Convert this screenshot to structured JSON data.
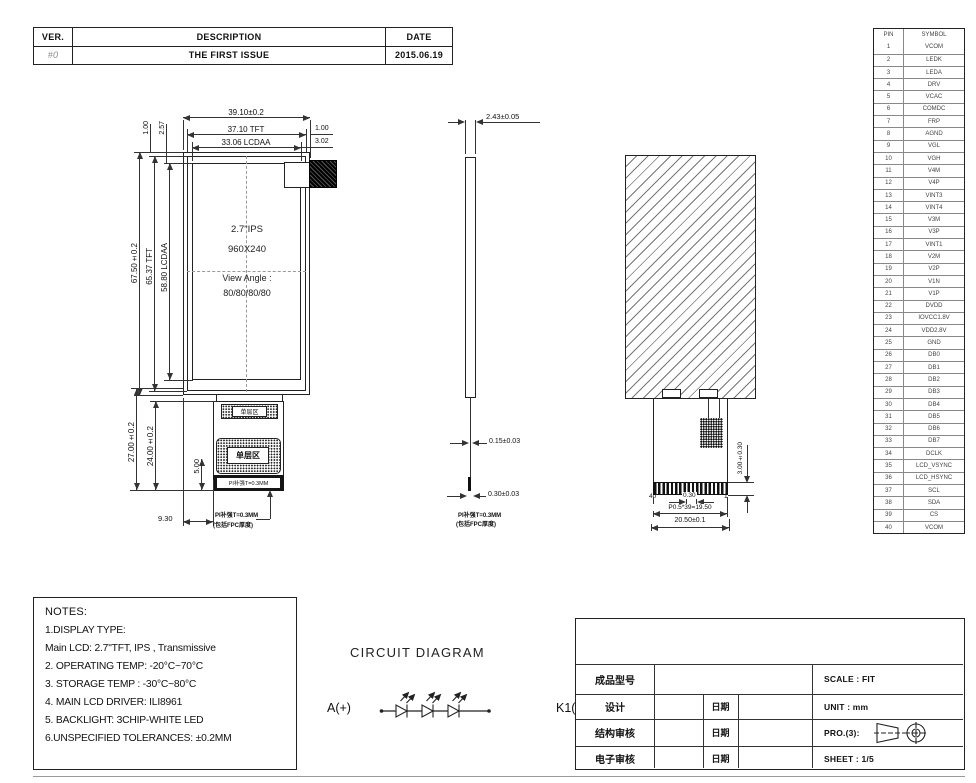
{
  "revision_table": {
    "headers": {
      "ver": "VER.",
      "description": "DESCRIPTION",
      "date": "DATE"
    },
    "rows": [
      {
        "ver": "#0",
        "description": "THE FIRST ISSUE",
        "date": "2015.06.19"
      }
    ]
  },
  "pin_table": {
    "col_pin": "PIN",
    "col_symbol": "SYMBOL",
    "pins": [
      {
        "pin": "1",
        "symbol": "VCOM"
      },
      {
        "pin": "2",
        "symbol": "LEDK"
      },
      {
        "pin": "3",
        "symbol": "LEDA"
      },
      {
        "pin": "4",
        "symbol": "DRV"
      },
      {
        "pin": "5",
        "symbol": "VCAC"
      },
      {
        "pin": "6",
        "symbol": "COMDC"
      },
      {
        "pin": "7",
        "symbol": "FRP"
      },
      {
        "pin": "8",
        "symbol": "AGND"
      },
      {
        "pin": "9",
        "symbol": "VGL"
      },
      {
        "pin": "10",
        "symbol": "VGH"
      },
      {
        "pin": "11",
        "symbol": "V4M"
      },
      {
        "pin": "12",
        "symbol": "V4P"
      },
      {
        "pin": "13",
        "symbol": "VINT3"
      },
      {
        "pin": "14",
        "symbol": "VINT4"
      },
      {
        "pin": "15",
        "symbol": "V3M"
      },
      {
        "pin": "16",
        "symbol": "V3P"
      },
      {
        "pin": "17",
        "symbol": "VINT1"
      },
      {
        "pin": "18",
        "symbol": "V2M"
      },
      {
        "pin": "19",
        "symbol": "V2P"
      },
      {
        "pin": "20",
        "symbol": "V1N"
      },
      {
        "pin": "21",
        "symbol": "V1P"
      },
      {
        "pin": "22",
        "symbol": "DVDD"
      },
      {
        "pin": "23",
        "symbol": "IOVCC1.8V"
      },
      {
        "pin": "24",
        "symbol": "VDD2.8V"
      },
      {
        "pin": "25",
        "symbol": "GND"
      },
      {
        "pin": "26",
        "symbol": "DB0"
      },
      {
        "pin": "27",
        "symbol": "DB1"
      },
      {
        "pin": "28",
        "symbol": "DB2"
      },
      {
        "pin": "29",
        "symbol": "DB3"
      },
      {
        "pin": "30",
        "symbol": "DB4"
      },
      {
        "pin": "31",
        "symbol": "DB5"
      },
      {
        "pin": "32",
        "symbol": "DB6"
      },
      {
        "pin": "33",
        "symbol": "DB7"
      },
      {
        "pin": "34",
        "symbol": "DCLK"
      },
      {
        "pin": "35",
        "symbol": "LCD_VSYNC"
      },
      {
        "pin": "36",
        "symbol": "LCD_HSYNC"
      },
      {
        "pin": "37",
        "symbol": "SCL"
      },
      {
        "pin": "38",
        "symbol": "SDA"
      },
      {
        "pin": "39",
        "symbol": "CS"
      },
      {
        "pin": "40",
        "symbol": "VCOM"
      }
    ]
  },
  "front_view": {
    "display_text": {
      "line1": "2.7\"IPS",
      "line2": "960X240",
      "line3": "View Angle :",
      "line4": "80/80/80/80"
    },
    "dims": {
      "width_overall": "39.10±0.2",
      "width_tft": "37.10 TFT",
      "width_aa": "33.06 LCDAA",
      "margin_right_tft": "1.00",
      "margin_right_aa": "3.02",
      "margin_top_tft": "1.00",
      "margin_top_aa": "2.57",
      "height_overall": "67.50±0.2",
      "height_tft": "65.37 TFT",
      "height_aa": "58.80 LCDAA",
      "fpc_height_overall": "27.00±0.2",
      "fpc_height": "24.00±0.2",
      "stiffener_offset": "5.00",
      "fpc_offset_x": "9.30"
    },
    "fpc": {
      "single_layer_top": "单层区",
      "single_layer_main": "单层区",
      "stiffener_bar": "PI补强T=0.3MM",
      "note_line1": "PI补强T=0.3MM",
      "note_line2": "(包括FPC厚度)"
    }
  },
  "side_view": {
    "dims": {
      "thickness": "2.43±0.05",
      "fpc_thickness": "0.15±0.03",
      "stiffener_thickness": "0.30±0.03"
    },
    "note_line1": "PI补强T=0.3MM",
    "note_line2": "(包括FPC厚度)"
  },
  "back_view": {
    "dims": {
      "connector_height": "3.00±0.30",
      "pin_pitch": "0.30",
      "pitch_total": "P0.5*39=19.50",
      "fpc_width": "20.50±0.1"
    },
    "pin_last": "40",
    "pin_first": "1"
  },
  "circuit": {
    "title": "CIRCUIT DIAGRAM",
    "anode_label": "A(+)",
    "cathode_label": "K1(-)"
  },
  "notes": {
    "title": "NOTES:",
    "lines": [
      "1.DISPLAY TYPE:",
      "Main LCD: 2.7\"TFT, IPS , Transmissive",
      "2. OPERATING TEMP: -20°C~70°C",
      "3. STORAGE TEMP : -30°C~80°C",
      "4. MAIN LCD DRIVER: ILI8961",
      "5. BACKLIGHT: 3CHIP-WHITE LED",
      "6.UNSPECIFIED TOLERANCES: ±0.2MM"
    ]
  },
  "title_block": {
    "product_model_label": "成品型号",
    "design_label": "设计",
    "structure_review_label": "结构审核",
    "electronic_review_label": "电子审核",
    "date_label": "日期",
    "scale": "SCALE : FIT",
    "unit": "UNIT : mm",
    "projection": "PRO.(3):",
    "sheet": "SHEET : 1/5"
  },
  "colors": {
    "line": "#333333",
    "background": "#ffffff"
  }
}
